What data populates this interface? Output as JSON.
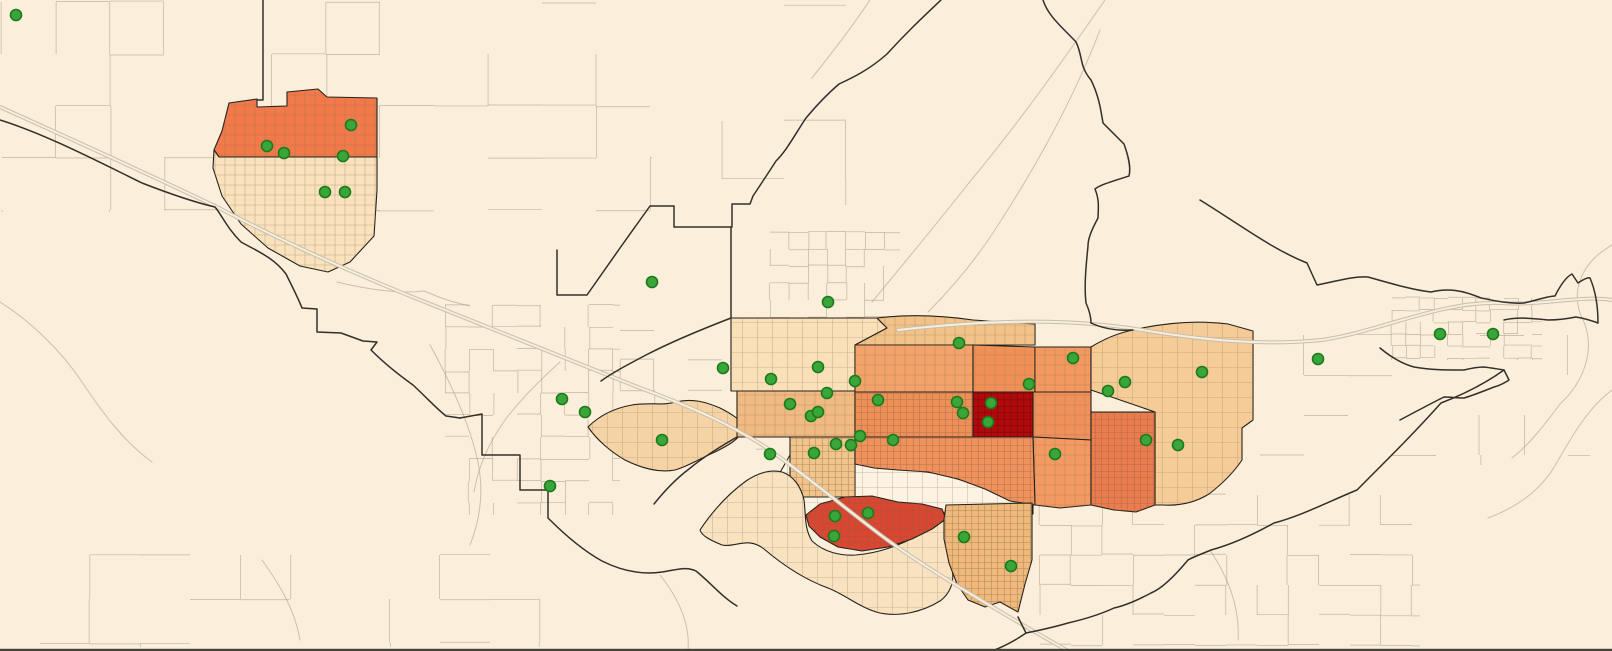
{
  "map": {
    "background": "#fbeeda",
    "bottom_edge_color": "#46423a",
    "styles": {
      "boundary_color": "#33302a",
      "wash_color": "#c3b7a2",
      "street_color": "#a99c87",
      "highway_casing": "#c9bead",
      "highway_fill": "#f7eedb",
      "tract_outline": "#23211c",
      "marker": {
        "fill": "#3aa63a",
        "stroke": "#1d7a1c",
        "radius": 5.5
      }
    },
    "choropleth_palette": [
      "#fdf3e2",
      "#f9e2c0",
      "#f6d3a4",
      "#f5cc97",
      "#f2c289",
      "#f0ba82",
      "#f0b97c",
      "#f3a369",
      "#f2935c",
      "#f0905a",
      "#ec7c4e",
      "#f2794a",
      "#da4632",
      "#b00a0c"
    ],
    "tracts": [
      {
        "id": "gap-white",
        "fill": "#fdf3e2",
        "hatch": "light",
        "path": "M 766,497 L 790,455 L 855,452 L 855,464 L 898,468 L 940,474 L 985,487 L 1033,503 L 1033,514 L 988,519 L 944,513 L 900,509 L 860,513 L 820,519 L 790,514 Z"
      },
      {
        "id": "nw-town-north",
        "fill": "#f2794a",
        "hatch": "med",
        "path": "M 214,150 L 222,131 L 229,103 L 257,99 L 257,107 L 287,106 L 287,92 L 318,89 L 327,97 L 377,98 L 377,157 L 219,157 Z"
      },
      {
        "id": "nw-town-south",
        "fill": "#f9e2bc",
        "hatch": "med",
        "path": "M 214,150 L 219,157 L 377,157 L 377,190 L 374,236 L 350,262 L 328,272 L 300,266 L 268,248 L 241,224 L 222,196 L 213,168 Z"
      },
      {
        "id": "west-blob",
        "fill": "#f6d3a4",
        "hatch": "light",
        "path": "M 588,427 C 600,415 615,408 632,405 C 650,402 662,406 676,402 C 692,398 706,402 720,408 C 732,414 741,420 745,428 C 739,440 727,446 715,452 C 701,458 689,466 675,470 C 659,473 641,468 625,460 C 611,452 597,440 588,427 Z"
      },
      {
        "id": "c-pale",
        "fill": "#f9e0b8",
        "hatch": "light",
        "path": "M 731,318 L 877,318 L 887,328 L 855,345 L 855,391 L 731,391 Z"
      },
      {
        "id": "c-topstrip",
        "fill": "#f2c289",
        "hatch": "med",
        "path": "M 877,318 C 910,314 945,316 973,320 L 1035,324 L 1035,345 L 855,345 L 887,328 Z"
      },
      {
        "id": "c-orange-1",
        "fill": "#f3a369",
        "hatch": "med",
        "path": "M 855,345 L 973,345 L 973,392 L 855,392 Z"
      },
      {
        "id": "c-orange-2",
        "fill": "#f09056",
        "hatch": "med",
        "path": "M 973,345 L 1035,347 L 1035,392 L 973,392 Z"
      },
      {
        "id": "c-east-upper",
        "fill": "#f3995f",
        "hatch": "med",
        "path": "M 1035,347 L 1091,347 L 1091,392 L 1035,392 Z"
      },
      {
        "id": "ne-tan",
        "fill": "#f5cc97",
        "hatch": "light",
        "path": "M 1091,347 C 1104,339 1118,333 1133,330 C 1163,323 1196,320 1228,324 L 1253,331 L 1253,420 L 1242,428 L 1242,460 C 1234,472 1222,484 1209,494 C 1196,502 1180,506 1163,505 L 1155,505 L 1155,412 L 1091,390 Z"
      },
      {
        "id": "c-band",
        "fill": "#f0ba82",
        "hatch": "med",
        "path": "M 737,391 L 855,391 L 855,437 L 737,437 Z"
      },
      {
        "id": "c-orange-3",
        "fill": "#ef8f58",
        "hatch": "dense",
        "path": "M 855,392 L 973,392 L 973,437 L 855,437 Z"
      },
      {
        "id": "c-dark-red",
        "fill": "#b00a0c",
        "hatch": "red",
        "path": "M 973,392 L 1033,392 L 1033,437 L 973,437 Z"
      },
      {
        "id": "c-east-mid",
        "fill": "#f0905a",
        "hatch": "med",
        "path": "M 1033,392 L 1091,392 L 1091,440 L 1033,437 Z"
      },
      {
        "id": "c-east-lower",
        "fill": "#f39a62",
        "hatch": "med",
        "path": "M 1033,437 L 1091,440 L 1091,505 L 1060,508 L 1035,505 Z"
      },
      {
        "id": "c-hatch-tan",
        "fill": "#f1c48c",
        "hatch": "dense",
        "path": "M 790,437 L 855,437 L 855,497 L 790,497 Z"
      },
      {
        "id": "c-orange-south",
        "fill": "#f1925d",
        "hatch": "dense",
        "path": "M 855,437 L 1033,437 L 1035,505 L 1010,501 L 985,489 L 958,479 L 928,472 L 898,470 L 874,468 L 855,464 Z"
      },
      {
        "id": "c-deep-vert",
        "fill": "#ec7c4e",
        "hatch": "dense",
        "path": "M 1091,412 L 1155,412 L 1155,505 L 1136,512 L 1114,510 L 1091,505 Z"
      },
      {
        "id": "south-pale",
        "fill": "#f9e2c0",
        "hatch": "light",
        "path": "M 700,530 C 712,512 728,494 746,481 C 758,473 770,469 782,472 C 794,476 801,487 804,500 C 806,515 804,528 812,541 C 824,552 840,556 856,555 C 878,553 900,546 922,533 C 932,527 940,521 945,519 C 948,530 945,545 950,562 C 956,578 952,592 940,601 C 922,612 900,617 880,613 C 860,608 846,595 828,588 C 806,580 784,566 764,549 C 748,536 735,548 722,545 C 710,540 702,536 700,530 Z"
      },
      {
        "id": "red-strip",
        "fill": "#da4632",
        "hatch": "dense",
        "path": "M 806,515 L 820,504 L 845,497 L 872,496 L 898,502 L 922,504 L 942,509 L 946,519 L 932,529 L 912,539 L 888,547 L 862,551 L 838,547 L 820,537 L 809,526 Z"
      },
      {
        "id": "se-tan",
        "fill": "#f0b97c",
        "hatch": "dense",
        "path": "M 946,505 L 1032,503 L 1032,560 L 1025,584 L 1018,612 L 1000,602 L 985,607 L 968,600 L 957,584 L 949,563 L 944,539 L 944,519 Z"
      }
    ],
    "boundaries": [
      "M 0,120 C 45,134 95,160 142,183 C 178,197 202,204 215,207 C 223,217 227,228 241,242 C 259,252 274,258 286,274 C 293,288 299,300 302,308 L 317,309 L 317,332 L 341,333 L 363,341 L 377,342 L 371,350 C 383,362 399,375 413,385 C 427,398 436,408 446,416 L 460,418",
      "M 460,418 L 482,414 L 482,455 L 520,455 L 520,490 L 548,490 L 548,518 C 564,534 582,550 602,561 C 622,571 642,575 662,572 C 676,570 686,566 696,571 C 712,584 722,597 737,606",
      "M 941,0 C 922,18 906,33 887,54 C 869,70 852,78 839,84 C 825,96 816,106 806,118 C 794,136 787,150 776,161 C 767,175 759,187 753,196 L 750,204 L 732,204 L 732,227 L 674,227 L 674,206 L 650,206 L 620,248 L 587,295 L 557,295 L 557,250",
      "M 731,227 L 731,318",
      "M 1043,0 C 1048,16 1062,27 1076,42 C 1083,56 1079,66 1091,80 C 1099,96 1101,111 1103,123 C 1113,133 1120,140 1124,144 C 1129,158 1131,168 1129,176 C 1110,182 1100,185 1095,189 C 1100,201 1098,211 1098,218 C 1091,231 1088,239 1088,246 C 1086,266 1084,286 1086,303 C 1090,312 1091,318 1091,323",
      "M 731,318 C 700,330 671,342 646,355 C 627,365 612,373 601,381",
      "M 737,437 C 716,449 701,459 689,469 C 673,481 662,494 654,504",
      "M 263,0 L 263,100 L 257,100",
      "M 1091,323 C 1104,329 1118,331 1133,330",
      "M 1200,200 C 1242,226 1272,249 1307,263 L 1317,285 C 1341,280 1356,276 1368,277 C 1396,285 1414,290 1431,292 C 1448,288 1462,290 1481,298 C 1496,301 1510,304 1524,303 C 1538,300 1548,296 1555,296 C 1560,286 1566,277 1572,274 L 1578,283 C 1584,279 1588,277 1590,278 C 1596,292 1598,308 1598,323 C 1590,320 1582,318 1576,317 C 1566,319 1556,320 1548,320 C 1530,318 1515,317 1504,320",
      "M 1380,348 C 1392,358 1403,364 1414,367 C 1430,370 1446,370 1464,370 C 1472,368 1478,367 1484,367 C 1492,368 1498,369 1504,370 L 1509,380 C 1503,384 1498,386 1494,387 C 1484,391 1474,395 1464,398 C 1457,398 1450,397 1444,397 C 1430,404 1415,412 1400,420",
      "M 1504,370 C 1483,385 1462,395 1441,403 C 1416,431 1391,456 1357,490 C 1330,501 1301,516 1274,523 C 1247,538 1226,546 1211,550 C 1199,555 1191,558 1188,560 C 1173,578 1161,589 1151,593 C 1136,601 1123,606 1114,608 C 1099,615 1081,620 1068,623 C 1051,628 1036,631 1026,633 L 1018,617",
      "M 1026,633 C 1016,640 1005,646 992,651"
    ],
    "highways": [
      "M 0,107 C 80,143 150,175 215,206 C 280,240 345,270 420,300 C 500,332 572,361 640,388 C 700,410 732,426 764,446 C 802,472 842,506 882,536 C 922,566 990,606 1042,636 L 1068,651",
      "M 898,330 C 980,321 1062,317 1142,330 C 1202,340 1262,346 1322,340 C 1382,331 1440,301 1500,303 C 1542,306 1582,295 1612,300"
    ],
    "washes": [
      "M 337,282 C 370,290 400,294 424,291 C 443,299 452,302 470,306",
      "M 1105,0 C 1062,62 1018,124 968,184 C 935,226 905,262 872,302",
      "M 1100,30 C 1075,95 1040,160 1000,222 C 975,262 950,290 928,312",
      "M 1612,245 C 1582,262 1568,292 1584,322 C 1596,352 1582,384 1560,404 C 1545,424 1530,444 1512,458",
      "M 1612,390 C 1588,408 1572,436 1556,464 C 1540,492 1515,508 1488,518",
      "M 0,302 C 32,322 62,352 82,382 C 102,412 124,442 152,462",
      "M 430,345 C 452,385 470,425 478,462 C 484,492 480,520 470,545",
      "M 262,560 C 280,585 295,610 300,640",
      "M 660,575 C 680,600 690,625 688,650",
      "M 1210,550 C 1230,580 1240,610 1238,640",
      "M 870,0 C 850,30 830,55 812,78",
      "M 560,362 C 540,380 520,400 505,420 C 488,444 478,468 474,492"
    ],
    "street_grids": [
      {
        "x": 2,
        "y": 2,
        "w": 650,
        "h": 210,
        "sx": 54,
        "sy": 52,
        "keep": 0.5,
        "seed": 7
      },
      {
        "x": 660,
        "y": 5,
        "w": 230,
        "h": 200,
        "sx": 62,
        "sy": 58,
        "keep": 0.3,
        "seed": 11
      },
      {
        "x": 1040,
        "y": 495,
        "w": 380,
        "h": 150,
        "sx": 31,
        "sy": 30,
        "keep": 0.5,
        "seed": 23
      },
      {
        "x": 40,
        "y": 555,
        "w": 500,
        "h": 92,
        "sx": 50,
        "sy": 44,
        "keep": 0.42,
        "seed": 31
      },
      {
        "x": 1392,
        "y": 298,
        "w": 150,
        "h": 62,
        "sx": 14,
        "sy": 12,
        "keep": 0.75,
        "seed": 43
      },
      {
        "x": 445,
        "y": 305,
        "w": 175,
        "h": 210,
        "sx": 24,
        "sy": 22,
        "keep": 0.5,
        "seed": 53
      },
      {
        "x": 1260,
        "y": 335,
        "w": 330,
        "h": 130,
        "sx": 44,
        "sy": 40,
        "keep": 0.25,
        "seed": 61
      },
      {
        "x": 770,
        "y": 232,
        "w": 130,
        "h": 85,
        "sx": 19,
        "sy": 17,
        "keep": 0.6,
        "seed": 71
      },
      {
        "x": 620,
        "y": 330,
        "w": 150,
        "h": 120,
        "sx": 34,
        "sy": 30,
        "keep": 0.3,
        "seed": 83
      },
      {
        "x": 865,
        "y": 460,
        "w": 165,
        "h": 55,
        "sx": 16,
        "sy": 14,
        "keep": 0.6,
        "seed": 97
      }
    ],
    "markers": [
      [
        16,
        15
      ],
      [
        351,
        125
      ],
      [
        267,
        146
      ],
      [
        284,
        153
      ],
      [
        343,
        156
      ],
      [
        325,
        192
      ],
      [
        345,
        192
      ],
      [
        652,
        282
      ],
      [
        828,
        302
      ],
      [
        562,
        399
      ],
      [
        585,
        412
      ],
      [
        550,
        486
      ],
      [
        662,
        440
      ],
      [
        723,
        368
      ],
      [
        771,
        379
      ],
      [
        818,
        367
      ],
      [
        827,
        393
      ],
      [
        790,
        404
      ],
      [
        811,
        416
      ],
      [
        818,
        412
      ],
      [
        855,
        381
      ],
      [
        878,
        400
      ],
      [
        860,
        436
      ],
      [
        836,
        444
      ],
      [
        851,
        445
      ],
      [
        893,
        440
      ],
      [
        770,
        454
      ],
      [
        814,
        453
      ],
      [
        959,
        343
      ],
      [
        957,
        402
      ],
      [
        963,
        413
      ],
      [
        991,
        403
      ],
      [
        988,
        422
      ],
      [
        1029,
        384
      ],
      [
        1055,
        454
      ],
      [
        1073,
        358
      ],
      [
        1125,
        382
      ],
      [
        1108,
        391
      ],
      [
        1146,
        440
      ],
      [
        1178,
        445
      ],
      [
        1202,
        372
      ],
      [
        835,
        516
      ],
      [
        868,
        513
      ],
      [
        834,
        536
      ],
      [
        964,
        537
      ],
      [
        1011,
        566
      ],
      [
        1318,
        359
      ],
      [
        1440,
        334
      ],
      [
        1493,
        334
      ]
    ]
  }
}
